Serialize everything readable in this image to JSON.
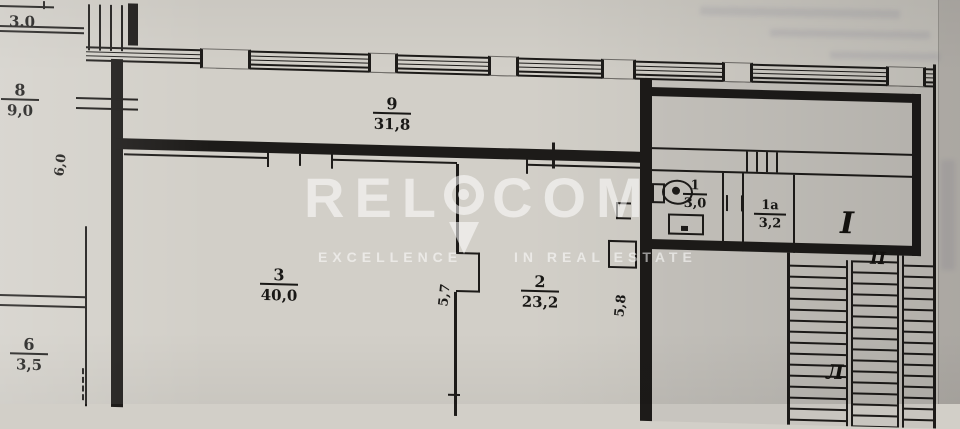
{
  "colors": {
    "paper": "#d2cfc8",
    "wall": "#1d1b19",
    "watermark": "#ffffff"
  },
  "watermark": {
    "brand_left": "REL",
    "brand_right": "COM",
    "tagline_left": "EXCELLENCE",
    "tagline_right": "IN REAL ESTATE"
  },
  "rooms": {
    "top_left_partial": {
      "number": "",
      "area": "3.0"
    },
    "r8": {
      "number": "8",
      "area": "9,0"
    },
    "r9": {
      "number": "9",
      "area": "31,8"
    },
    "r3": {
      "number": "3",
      "area": "40,0"
    },
    "r2": {
      "number": "2",
      "area": "23,2"
    },
    "r1": {
      "number": "1",
      "area": "3,0"
    },
    "r1a": {
      "number": "1а",
      "area": "3,2"
    },
    "r6": {
      "number": "6",
      "area": "3,5"
    }
  },
  "dimensions": {
    "left_wall": "6,0",
    "room3_depth": "5,7",
    "room2_depth": "5,8"
  },
  "markers": {
    "entrance_upper": "I",
    "entrance_lower": "II",
    "stair_letter": "Л"
  }
}
